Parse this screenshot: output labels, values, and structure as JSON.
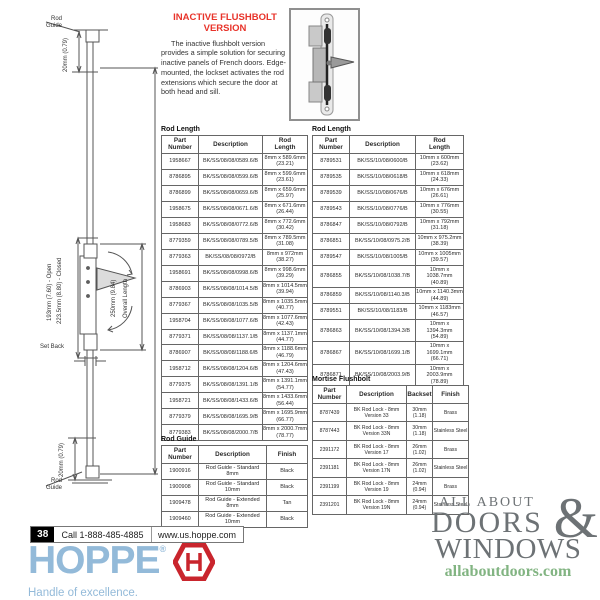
{
  "intro": {
    "title": "INACTIVE FLUSHBOLT\nVERSION",
    "body": "The inactive flushbolt version provides a simple solution for securing inactive panels of French doors.  Edge-mounted, the lockset activates the rod extensions which secure the door at both head and sill."
  },
  "diagram": {
    "rod_guide_top": "Rod\nGuide",
    "rod_guide_bottom": "Rod\nGuide",
    "dim_top": "20mm (0.79)",
    "dim_bottom": "20mm (0.79)",
    "dim_open": "193mm (7.60) - Open",
    "dim_closed": "223.5mm (8.80) - Closed",
    "dim_lock": "250mm (9.84)",
    "overall_length": "Overall Length",
    "set_back": "Set Back"
  },
  "tables": {
    "rod_length_8mm": {
      "title": "Rod Length",
      "headers": [
        "Part\nNumber",
        "Description",
        "Rod\nLength"
      ],
      "rows": [
        [
          "1958667",
          "BK/SS/08/08/0589.6/B",
          "8mm x 589.6mm\n(23.21)"
        ],
        [
          "8786895",
          "BK/SS/08/08/0599.6/B",
          "8mm x 599.6mm\n(23.61)"
        ],
        [
          "8786899",
          "BK/SS/08/08/0659.6/B",
          "8mm x 659.6mm\n(25.97)"
        ],
        [
          "1958675",
          "BK/SS/08/08/0671.6/B",
          "8mm x 671.6mm\n(26.44)"
        ],
        [
          "1958683",
          "BK/SS/08/08/0772.6/B",
          "8mm x 772.6mm\n(30.42)"
        ],
        [
          "8779359",
          "BK/SS/08/08/0789.5/B",
          "8mm x 789.5mm\n(31.08)"
        ],
        [
          "8779363",
          "BK/SS/08/08/0972/B",
          "8mm x 972mm\n(38.27)"
        ],
        [
          "1958691",
          "BK/SS/08/08/0998.6/B",
          "8mm x 998.6mm\n(39.29)"
        ],
        [
          "8786903",
          "BK/SS/08/08/1014.5/B",
          "8mm x 1014.5mm\n(39.94)"
        ],
        [
          "8779367",
          "BK/SS/08/08/1035.5/B",
          "8mm x 1035.5mm\n(40.77)"
        ],
        [
          "1958704",
          "BK/SS/08/08/1077.6/B",
          "8mm x 1077.6mm\n(42.43)"
        ],
        [
          "8779371",
          "BK/SS/08/08/1137.1/B",
          "8mm x 1137.1mm\n(44.77)"
        ],
        [
          "8786907",
          "BK/SS/08/08/1188.6/B",
          "8mm x 1188.6mm\n(46.79)"
        ],
        [
          "1958712",
          "BK/SS/08/08/1204.6/B",
          "8mm x 1204.6mm\n(47.43)"
        ],
        [
          "8779375",
          "BK/SS/08/08/1391.1/B",
          "8mm x 1391.1mm\n(54.77)"
        ],
        [
          "1958721",
          "BK/SS/08/08/1433.6/B",
          "8mm x 1433.6mm\n(56.44)"
        ],
        [
          "8779379",
          "BK/SS/08/08/1695.9/B",
          "8mm x 1695.9mm\n(66.77)"
        ],
        [
          "8779383",
          "BK/SS/08/08/2000.7/B",
          "8mm x 2000.7mm\n(78.77)"
        ]
      ]
    },
    "rod_length_10mm": {
      "title": "Rod Length",
      "headers": [
        "Part\nNumber",
        "Description",
        "Rod\nLength"
      ],
      "rows": [
        [
          "8789531",
          "BK/SS/10/08/0600/B",
          "10mm x 600mm\n(23.62)"
        ],
        [
          "8789535",
          "BK/SS/10/08/0618/B",
          "10mm x 618mm\n(24.33)"
        ],
        [
          "8789539",
          "BK/SS/10/08/0676/B",
          "10mm x 676mm\n(26.61)"
        ],
        [
          "8789543",
          "BK/SS/10/08/0776/B",
          "10mm x 776mm\n(30.55)"
        ],
        [
          "8786847",
          "BK/SS/10/08/0792/B",
          "10mm x 792mm\n(31.18)"
        ],
        [
          "8786851",
          "BK/SS/10/08/0975.2/B",
          "10mm x 975.2mm\n(38.39)"
        ],
        [
          "8789547",
          "BK/SS/10/08/1005/B",
          "10mm x 1005mm\n(39.57)"
        ],
        [
          "8786855",
          "BK/SS/10/08/1038.7/B",
          "10mm x 1038.7mm\n(40.89)"
        ],
        [
          "8786859",
          "BK/SS/10/08/1140.3/B",
          "10mm x 1140.3mm\n(44.89)"
        ],
        [
          "8789551",
          "BK/SS/10/08/1183/B",
          "10mm x 1183mm\n(46.57)"
        ],
        [
          "8786863",
          "BK/SS/10/08/1394.3/B",
          "10mm x 1394.3mm\n(54.89)"
        ],
        [
          "8786867",
          "BK/SS/10/08/1699.1/B",
          "10mm x 1699.1mm\n(66.71)"
        ],
        [
          "8786871",
          "BK/SS/10/08/2003.9/B",
          "10mm x 2003.9mm\n(78.89)"
        ]
      ]
    },
    "rod_guide": {
      "title": "Rod Guide",
      "headers": [
        "Part\nNumber",
        "Description",
        "Finish"
      ],
      "rows": [
        [
          "1900916",
          "Rod Guide - Standard\n8mm",
          "Black"
        ],
        [
          "1900908",
          "Rod Guide - Standard\n10mm",
          "Black"
        ],
        [
          "1909478",
          "Rod Guide - Extended\n8mm",
          "Tan"
        ],
        [
          "1909460",
          "Rod Guide - Extended\n10mm",
          "Black"
        ]
      ]
    },
    "mortise_flushbolt": {
      "title": "Mortise Flushbolt",
      "headers": [
        "Part\nNumber",
        "Description",
        "Backset",
        "Finish"
      ],
      "rows": [
        [
          "8787439",
          "BK Rod Lock - 8mm\nVersion 33",
          "30mm\n(1.18)",
          "Brass"
        ],
        [
          "8787443",
          "BK Rod Lock - 8mm\nVersion 33N",
          "30mm\n(1.18)",
          "Stainless Steel"
        ],
        [
          "2391172",
          "BK Rod Lock - 8mm\nVersion 17",
          "26mm\n(1.02)",
          "Brass"
        ],
        [
          "2391181",
          "BK Rod Lock - 8mm\nVersion 17N",
          "26mm\n(1.02)",
          "Stainless Steel"
        ],
        [
          "2391199",
          "BK Rod Lock - 8mm\nVersion 19",
          "24mm\n(0.94)",
          "Brass"
        ],
        [
          "2391201",
          "BK Rod Lock - 8mm\nVersion 19N",
          "24mm\n(0.94)",
          "Stainless Steel"
        ]
      ]
    }
  },
  "footer": {
    "page_number": "38",
    "phone": "Call 1-888-485-4885",
    "website": "www.us.hoppe.com"
  },
  "branding": {
    "hoppe_wordmark": "HOPPE",
    "registered_mark": "®",
    "hoppe_tagline": "Handle of excellence.",
    "hoppe_blue": "#93bad9",
    "hoppe_red": "#c9252d",
    "watermark_line1": "ALL ABOUT",
    "watermark_line2": "DOORS",
    "watermark_amp": "&",
    "watermark_line3": "WINDOWS",
    "watermark_url": "allaboutdoors.com",
    "title_red": "#e8332a"
  }
}
